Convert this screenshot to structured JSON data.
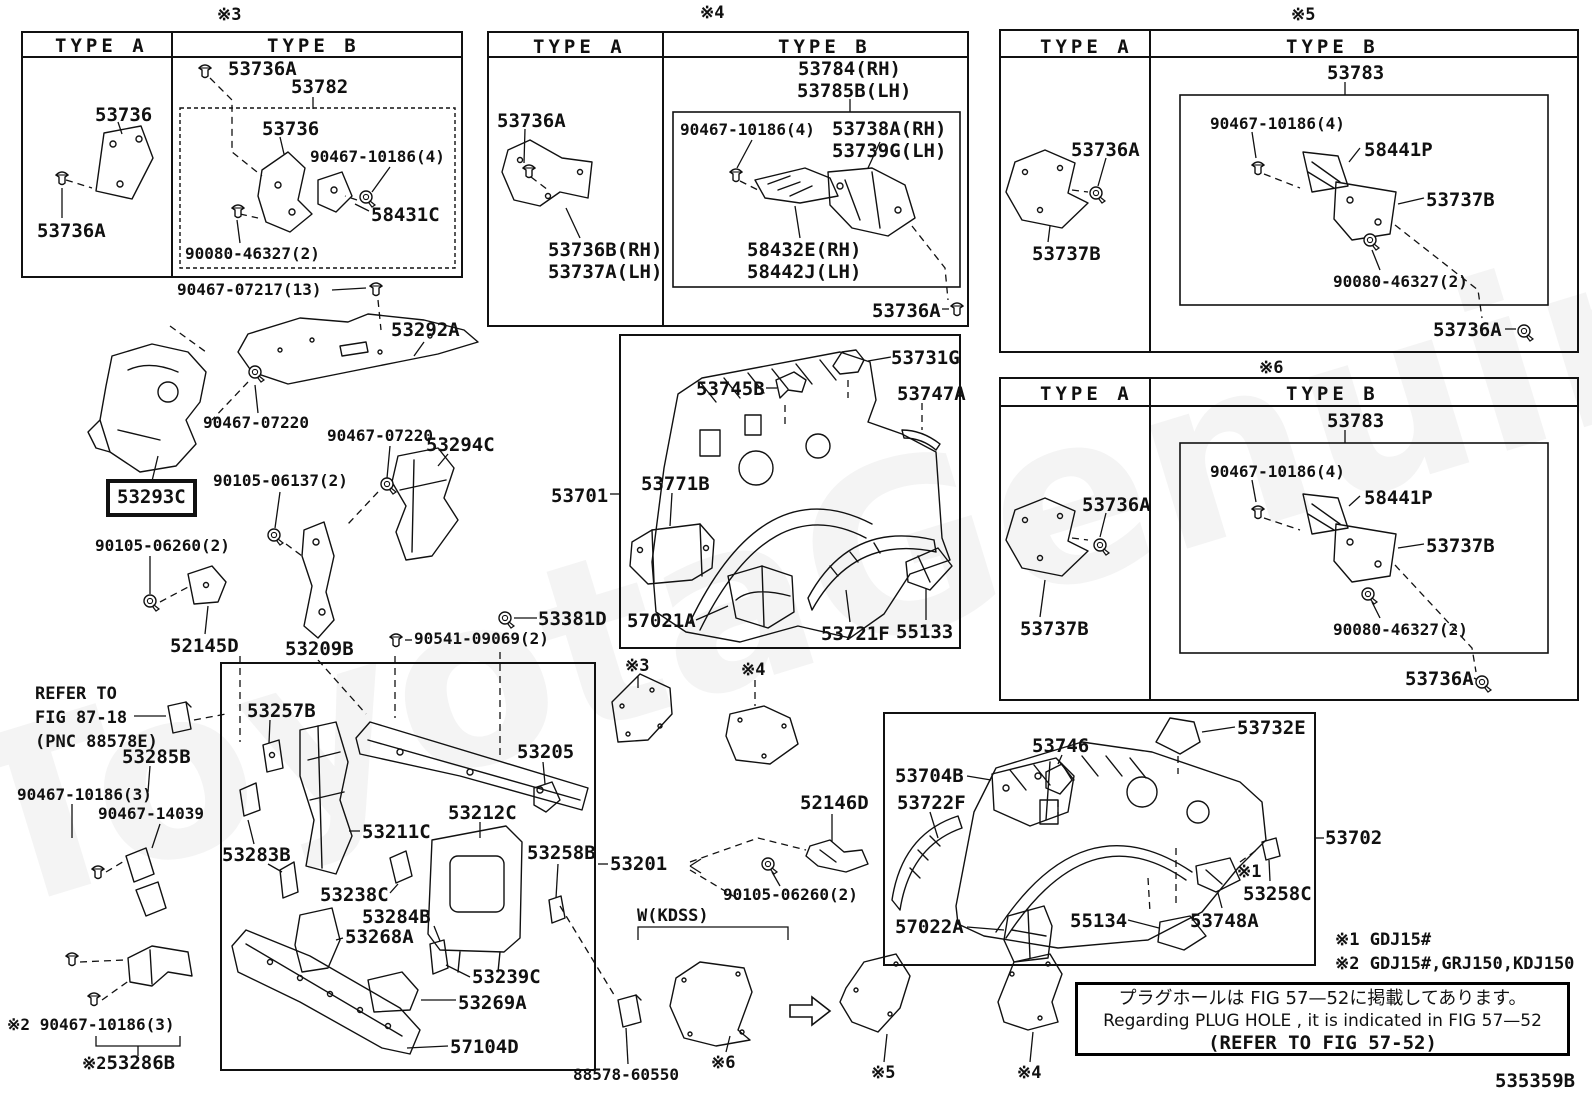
{
  "page": {
    "code": "535359B",
    "watermark": "ToyotaGenuine.ru"
  },
  "headers": {
    "type_a": "TYPE A",
    "type_b": "TYPE B"
  },
  "markers": {
    "m1": "※1",
    "m2": "※2",
    "m3": "※3",
    "m4": "※4",
    "m5": "※5",
    "m6": "※6"
  },
  "notes": {
    "note1": "※1 GDJ15#",
    "note2": "※2 GDJ15#,GRJ150,KDJ150",
    "plug_jp": "プラグホールは FIG 57—52に掲載してあります。",
    "plug_en": "Regarding PLUG HOLE , it is indicated in FIG 57—52",
    "plug_ref": "(REFER TO FIG 57-52)"
  },
  "misc": {
    "refer_line1": "REFER TO",
    "refer_line2": "FIG 87-18",
    "refer_line3": "(PNC 88578E)",
    "wkdss": "W(KDSS)"
  },
  "parts": {
    "p53736": "53736",
    "p53736a": "53736A",
    "p53782": "53782",
    "p58431c": "58431C",
    "p90467_10186_4": "90467-10186(4)",
    "p90080_46327_2": "90080-46327(2)",
    "p90467_07217_13": "90467-07217(13)",
    "p53784rh": "53784(RH)",
    "p53785blh": "53785B(LH)",
    "p53738arh": "53738A(RH)",
    "p53739glh": "53739G(LH)",
    "p53736brh": "53736B(RH)",
    "p53737alh": "53737A(LH)",
    "p58432erh": "58432E(RH)",
    "p58442jlh": "58442J(LH)",
    "p53783": "53783",
    "p58441p": "58441P",
    "p53737b": "53737B",
    "p53292a": "53292A",
    "p90467_07220": "90467-07220",
    "p53294c": "53294C",
    "p53293c": "53293C",
    "p90105_06137_2": "90105-06137(2)",
    "p90105_06260_2": "90105-06260(2)",
    "p52145d": "52145D",
    "p53209b": "53209B",
    "p90541_09069_2": "90541-09069(2)",
    "p53381d": "53381D",
    "p53701": "53701",
    "p53731g": "53731G",
    "p53745b": "53745B",
    "p53747a": "53747A",
    "p53771b": "53771B",
    "p57021a": "57021A",
    "p53721f": "53721F",
    "p55133": "55133",
    "p53285b": "53285B",
    "p90467_10186_3": "90467-10186(3)",
    "p90467_14039": "90467-14039",
    "p53283b": "53283B",
    "p53286b": "53286B",
    "p53257b": "53257B",
    "p53205": "53205",
    "p53212c": "53212C",
    "p53211c": "53211C",
    "p53258b": "53258B",
    "p53238c": "53238C",
    "p53284b": "53284B",
    "p53268a": "53268A",
    "p53239c": "53239C",
    "p53269a": "53269A",
    "p57104d": "57104D",
    "p53201": "53201",
    "p52146d": "52146D",
    "p88578_60550": "88578-60550",
    "p53732e": "53732E",
    "p53746": "53746",
    "p53704b": "53704B",
    "p53722f": "53722F",
    "p57022a": "57022A",
    "p55134": "55134",
    "p53748a": "53748A",
    "p53258c": "53258C",
    "p53702": "53702"
  }
}
